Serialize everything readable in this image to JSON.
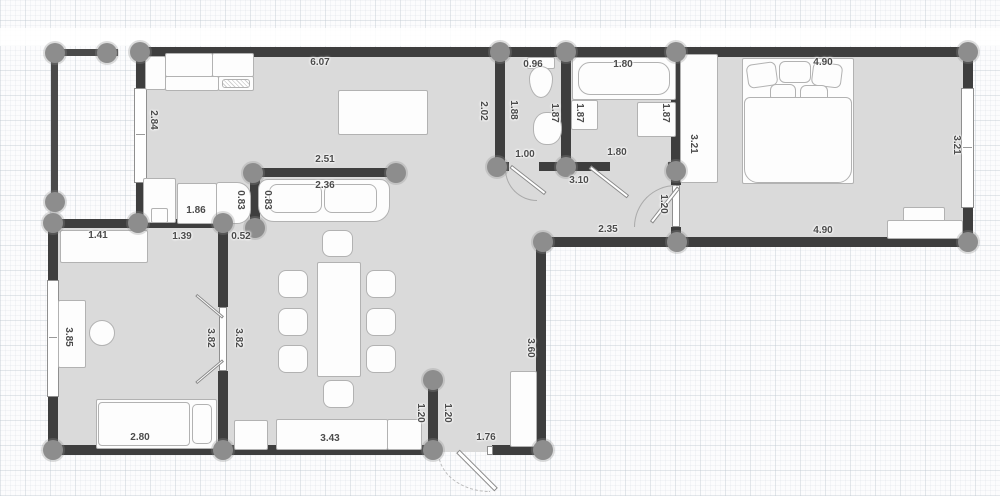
{
  "plan": {
    "type": "apartment-floor-plan",
    "colors": {
      "wall": "#3e3e3e",
      "floor": "#dadada",
      "post": "#8d8d8d",
      "furniture_fill": "#fdfdfd",
      "furniture_border": "#b2b2b2",
      "label_text": "#4b4b4b",
      "grid_line": "#bac3cd"
    }
  },
  "dims": {
    "kitchen_top": "6.07",
    "kitchen_left": "2.84",
    "partition": "2.51",
    "sofa": "2.36",
    "kitchen_counter": "1.86",
    "counter_depth_a": "0.83",
    "counter_depth_b": "0.83",
    "living_right": "2.02",
    "wc_left": "1.88",
    "wc_top": "0.96",
    "wc_right": "1.87",
    "wc_bottom": "1.00",
    "bath_tub": "1.80",
    "bath_left": "1.87",
    "bath_right": "1.87",
    "bath_bottom": "1.80",
    "hall_top": "3.10",
    "wardrobe_height": "3.21",
    "bedroom_top": "4.90",
    "bedroom_right": "3.21",
    "bedroom_door": "1.20",
    "hall_bottom": "2.35",
    "bedroom_bottom": "4.90",
    "kids_cabinet": "1.41",
    "kids_top": "1.39",
    "kids_wall": "0.52",
    "kids_left": "3.85",
    "kids_door_left": "3.82",
    "kids_door_right": "3.82",
    "kids_bed": "2.80",
    "sideboard": "3.43",
    "stub_left": "1.20",
    "stub_right": "1.20",
    "entry_door": "1.76",
    "dining_right": "3.60"
  }
}
